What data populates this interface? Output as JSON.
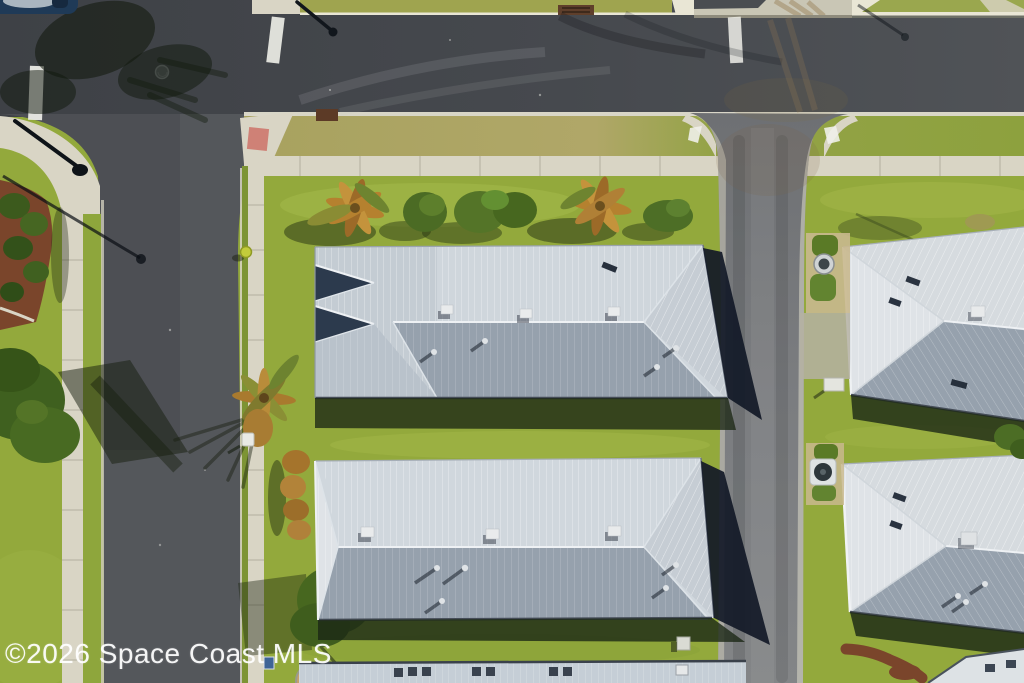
{
  "watermark": {
    "text": "©2026 Space Coast MLS"
  },
  "palette": {
    "asphalt": "#43464b",
    "asphalt_light": "#54575b",
    "street": "#77797c",
    "concrete": "#d9d5c5",
    "curb": "#e9e6d5",
    "grass": "#93a93c",
    "grass_bright": "#a6b84c",
    "grass_olive": "#a6a458",
    "grass_dark": "#6f8c2f",
    "roof_sunlit": "#d0d7dd",
    "roof_shaded": "#96a1ad",
    "roof_pale": "#dfe3e7",
    "roof_ridge": "#eef1f4",
    "roof_edge": "#454c57",
    "house_shadow": "#121927",
    "lawn_shadow": "#1c2815",
    "tree_green": "#476722",
    "palm_orange": "#b5812f",
    "bush_rust": "#a5742c",
    "mulch": "#7a452b",
    "red_mat": "#cf8176",
    "marking_white": "#efefe9",
    "watermark_color": "rgba(255,255,255,0.93)"
  }
}
